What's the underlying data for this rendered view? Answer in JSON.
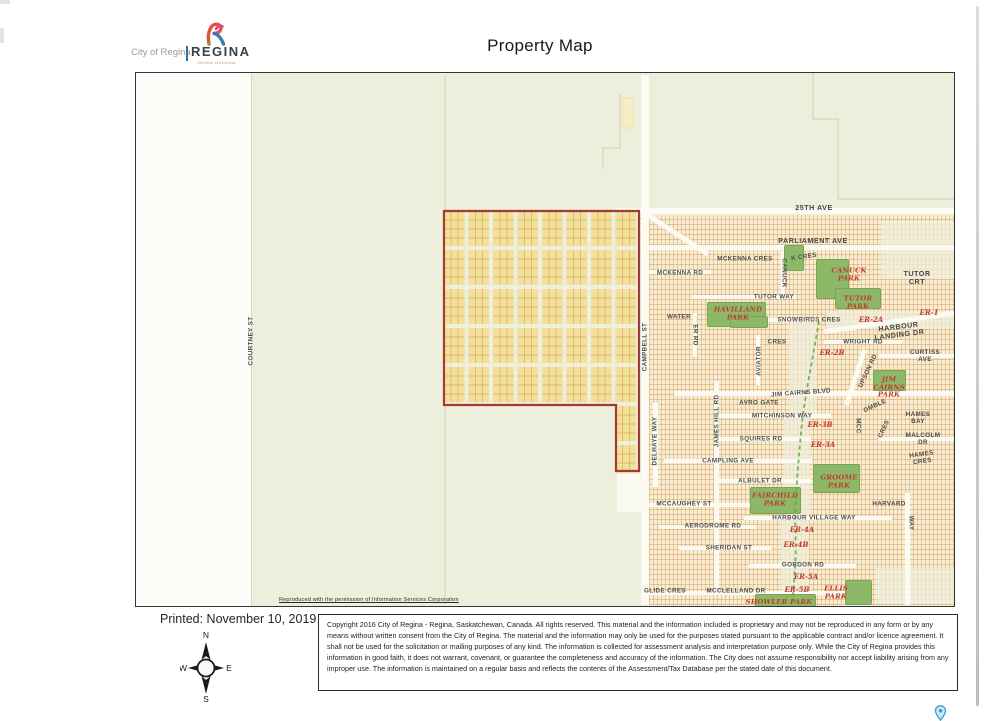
{
  "page": {
    "title": "Property Map"
  },
  "logo": {
    "city_text": "City of Regina",
    "brand": "REGINA",
    "tagline": "Infinite Horizons"
  },
  "map": {
    "attribution": "Reproduced with the permission of Information Services Corporation",
    "labels": [
      {
        "text": "COURTNEY ST",
        "x": 115,
        "y": 268,
        "rot": -90,
        "cls": "s"
      },
      {
        "text": "25TH AVE",
        "x": 678,
        "y": 135,
        "rot": 0,
        "cls": "slg"
      },
      {
        "text": "PARLIAMENT AVE",
        "x": 677,
        "y": 168,
        "rot": 0,
        "cls": "slg"
      },
      {
        "text": "MCKENNA CRES",
        "x": 609,
        "y": 186,
        "rot": 0,
        "cls": "s"
      },
      {
        "text": "K CRES",
        "x": 668,
        "y": 184,
        "rot": -8,
        "cls": "s"
      },
      {
        "text": "CANUCK",
        "x": 648,
        "y": 200,
        "rot": 90,
        "cls": "s"
      },
      {
        "text": "MCKENNA RD",
        "x": 544,
        "y": 200,
        "rot": 0,
        "cls": "s"
      },
      {
        "text": "TUTOR CRT",
        "x": 781,
        "y": 205,
        "rot": 0,
        "cls": "slg"
      },
      {
        "text": "TUTOR WAY",
        "x": 638,
        "y": 224,
        "rot": 0,
        "cls": "s"
      },
      {
        "text": "WATER",
        "x": 543,
        "y": 244,
        "rot": 0,
        "cls": "s"
      },
      {
        "text": "ER RD",
        "x": 559,
        "y": 262,
        "rot": 90,
        "cls": "s"
      },
      {
        "text": "SNOWBIRDS CRES",
        "x": 673,
        "y": 247,
        "rot": 0,
        "cls": "s"
      },
      {
        "text": "HARBOUR LANDING DR",
        "x": 763,
        "y": 258,
        "rot": -7,
        "cls": "slg"
      },
      {
        "text": "WRIGHT RD",
        "x": 727,
        "y": 269,
        "rot": 0,
        "cls": "s"
      },
      {
        "text": "CRES",
        "x": 641,
        "y": 269,
        "rot": 0,
        "cls": "s"
      },
      {
        "text": "AVIATOR",
        "x": 623,
        "y": 288,
        "rot": -90,
        "cls": "s"
      },
      {
        "text": "CURTISS AVE",
        "x": 789,
        "y": 283,
        "rot": 0,
        "cls": "s"
      },
      {
        "text": "UPSON RD",
        "x": 732,
        "y": 298,
        "rot": -65,
        "cls": "s"
      },
      {
        "text": "JIM CAIRNS BLVD",
        "x": 665,
        "y": 320,
        "rot": -4,
        "cls": "s"
      },
      {
        "text": "AVRO GATE",
        "x": 623,
        "y": 330,
        "rot": 0,
        "cls": "s"
      },
      {
        "text": "MITCHINSON WAY",
        "x": 646,
        "y": 343,
        "rot": 0,
        "cls": "s"
      },
      {
        "text": "OMBLE",
        "x": 739,
        "y": 333,
        "rot": -25,
        "cls": "s"
      },
      {
        "text": "MCC",
        "x": 722,
        "y": 353,
        "rot": 90,
        "cls": "s"
      },
      {
        "text": "CRES",
        "x": 748,
        "y": 356,
        "rot": -65,
        "cls": "s"
      },
      {
        "text": "HAMES BAY",
        "x": 782,
        "y": 345,
        "rot": 0,
        "cls": "s"
      },
      {
        "text": "SQUIRES RD",
        "x": 625,
        "y": 366,
        "rot": 0,
        "cls": "s"
      },
      {
        "text": "MALCOLM DR",
        "x": 787,
        "y": 366,
        "rot": 0,
        "cls": "s"
      },
      {
        "text": "JAMES HILL RD",
        "x": 581,
        "y": 348,
        "rot": -90,
        "cls": "s"
      },
      {
        "text": "DELHAYE WAY",
        "x": 519,
        "y": 368,
        "rot": -90,
        "cls": "s"
      },
      {
        "text": "CAMPBELL ST",
        "x": 509,
        "y": 274,
        "rot": -90,
        "cls": "s"
      },
      {
        "text": "CAMPLING AVE",
        "x": 592,
        "y": 388,
        "rot": 0,
        "cls": "s"
      },
      {
        "text": "HAMES CRES",
        "x": 786,
        "y": 385,
        "rot": -8,
        "cls": "s"
      },
      {
        "text": "ALBULET DR",
        "x": 624,
        "y": 408,
        "rot": 0,
        "cls": "s"
      },
      {
        "text": "MCCAUGHEY ST",
        "x": 548,
        "y": 431,
        "rot": 0,
        "cls": "s"
      },
      {
        "text": "HARVARD",
        "x": 753,
        "y": 431,
        "rot": 0,
        "cls": "s"
      },
      {
        "text": "WAY",
        "x": 775,
        "y": 450,
        "rot": 90,
        "cls": "s"
      },
      {
        "text": "HARBOUR VILLAGE WAY",
        "x": 678,
        "y": 445,
        "rot": 0,
        "cls": "s"
      },
      {
        "text": "AERODROME RD",
        "x": 577,
        "y": 453,
        "rot": 0,
        "cls": "s"
      },
      {
        "text": "SHERIDAN ST",
        "x": 593,
        "y": 475,
        "rot": 0,
        "cls": "s"
      },
      {
        "text": "GORDON RD",
        "x": 667,
        "y": 492,
        "rot": 0,
        "cls": "s"
      },
      {
        "text": "GLIDE CRES",
        "x": 529,
        "y": 518,
        "rot": 0,
        "cls": "s"
      },
      {
        "text": "MCCLELLAND DR",
        "x": 600,
        "y": 518,
        "rot": 0,
        "cls": "s"
      },
      {
        "text": "CANUCK\nPARK",
        "x": 713,
        "y": 202,
        "rot": 0,
        "cls": "p"
      },
      {
        "text": "TUTOR\nPARK",
        "x": 722,
        "y": 230,
        "rot": 0,
        "cls": "p"
      },
      {
        "text": "HAVILLAND\nPARK",
        "x": 602,
        "y": 241,
        "rot": 0,
        "cls": "p"
      },
      {
        "text": "JIM\nCAIRNS\nPARK",
        "x": 753,
        "y": 315,
        "rot": 0,
        "cls": "p"
      },
      {
        "text": "GROOME\nPARK",
        "x": 703,
        "y": 409,
        "rot": 0,
        "cls": "p"
      },
      {
        "text": "FAIRCHILD\nPARK",
        "x": 639,
        "y": 427,
        "rot": 0,
        "cls": "p"
      },
      {
        "text": "ELLIS\nPARK",
        "x": 700,
        "y": 520,
        "rot": 0,
        "cls": "p"
      },
      {
        "text": "SHOWLER PARK",
        "x": 643,
        "y": 530,
        "rot": 0,
        "cls": "p"
      },
      {
        "text": "ER-1",
        "x": 793,
        "y": 240,
        "rot": 0,
        "cls": "e"
      },
      {
        "text": "ER-2A",
        "x": 735,
        "y": 247,
        "rot": 0,
        "cls": "e"
      },
      {
        "text": "ER-2B",
        "x": 696,
        "y": 280,
        "rot": 0,
        "cls": "e"
      },
      {
        "text": "ER-3B",
        "x": 684,
        "y": 352,
        "rot": 0,
        "cls": "e"
      },
      {
        "text": "ER-3A",
        "x": 687,
        "y": 372,
        "rot": 0,
        "cls": "e"
      },
      {
        "text": "ER-4A",
        "x": 666,
        "y": 457,
        "rot": 0,
        "cls": "e"
      },
      {
        "text": "ER-4B",
        "x": 660,
        "y": 472,
        "rot": 0,
        "cls": "e"
      },
      {
        "text": "ER-5A",
        "x": 670,
        "y": 504,
        "rot": 0,
        "cls": "e"
      },
      {
        "text": "ER-5B",
        "x": 661,
        "y": 517,
        "rot": 0,
        "cls": "e"
      }
    ]
  },
  "footer": {
    "printed": "Printed: November 10, 2019",
    "compass": {
      "n": "N",
      "e": "E",
      "s": "S",
      "w": "W"
    },
    "copyright": "Copyright 2016 City of Regina - Regina, Saskatchewan, Canada. All rights reserved. This material and the information included is proprietary and may not be reproduced in any form or by any means without written consent from the City of Regina. The material and the information may only be used for the purposes stated pursuant to the applicable contract and/or licence agreement. It shall not be used for the solicitation or mailing purposes of any kind. The information is collected for assessment analysis and interpretation purpose only. While the City of Regina provides this information in good faith, it does not warrant, covenant, or guarantee the completeness and accuracy of the information. The City does not assume responsibility nor accept liability arising from any improper use. The information is maintained on a regular basis and reflects the contents of the Assessment/Tax Database per the stated date of this document."
  },
  "colors": {
    "highlight_outline": "#a33b32",
    "highlight_fill": "#f2df9a",
    "map_background": "#eeeedc",
    "park_green": "#8cb868",
    "label_red": "#c23a2e",
    "street_label_gray": "#4d4d4d",
    "logo_blue": "#2e6da4",
    "pin_blue": "#3d9fd6"
  }
}
